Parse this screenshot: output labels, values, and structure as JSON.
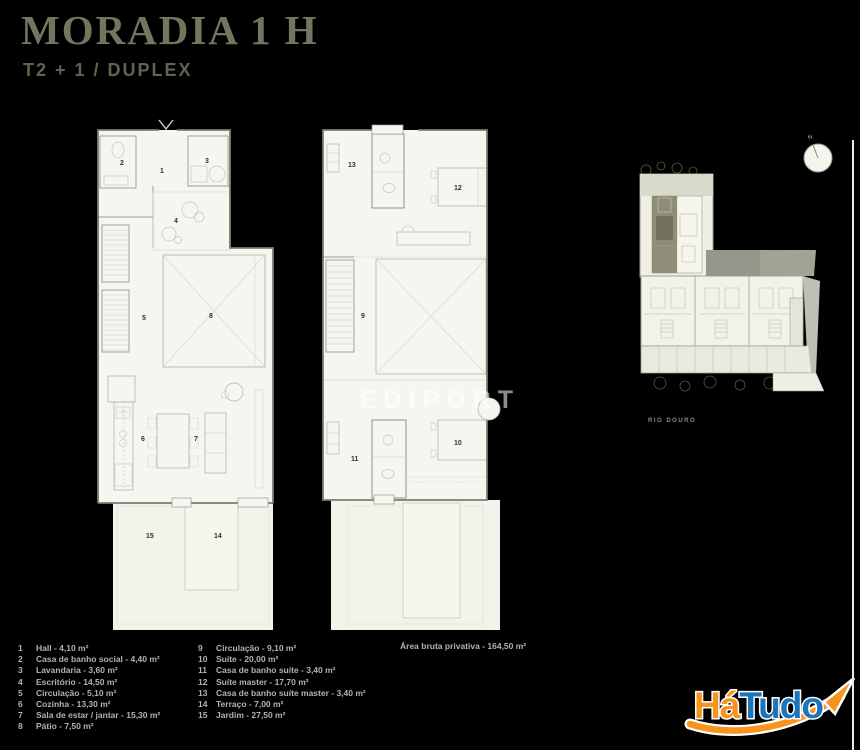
{
  "header": {
    "title": "MORADIA 1 H",
    "subtitle": "T2 + 1 / DUPLEX"
  },
  "room_numbers": {
    "hall": "1",
    "wc_social": "2",
    "lavandaria": "3",
    "escritorio": "4",
    "circulacao_0": "5",
    "cozinha": "6",
    "sala": "7",
    "patio": "8",
    "circulacao_1": "9",
    "suite": "10",
    "wc_suite": "11",
    "suite_master": "12",
    "wc_suite_master": "13",
    "terraco": "14",
    "jardim": "15"
  },
  "legend": {
    "col1": [
      {
        "num": "1",
        "label": "Hall - 4,10 m²"
      },
      {
        "num": "2",
        "label": "Casa de banho social - 4,40 m²"
      },
      {
        "num": "3",
        "label": "Lavandaria - 3,60 m²"
      },
      {
        "num": "4",
        "label": "Escritório - 14,50 m²"
      },
      {
        "num": "5",
        "label": "Circulação - 5,10 m²"
      },
      {
        "num": "6",
        "label": "Cozinha - 13,30 m²"
      },
      {
        "num": "7",
        "label": "Sala de estar / jantar - 15,30 m²"
      },
      {
        "num": "8",
        "label": "Pátio - 7,50 m²"
      }
    ],
    "col2": [
      {
        "num": "9",
        "label": "Circulação - 9,10 m²"
      },
      {
        "num": "10",
        "label": "Suíte - 20,00 m²"
      },
      {
        "num": "11",
        "label": "Casa de banho suíte - 3,40 m²"
      },
      {
        "num": "12",
        "label": "Suíte master - 17,70 m²"
      },
      {
        "num": "13",
        "label": "Casa de banho suíte master - 3,40 m²"
      },
      {
        "num": "14",
        "label": "Terraço - 7,00 m²"
      },
      {
        "num": "15",
        "label": "Jardim - 27,50 m²"
      }
    ],
    "total": "Área bruta privativa - 164,50 m²"
  },
  "site": {
    "caption": "RIO DOURO",
    "compass_label": "N"
  },
  "watermark": "EDIPORT",
  "logo": {
    "part1": "Há",
    "part2": "Tudo"
  },
  "colors": {
    "accent_orange": "#f7941d",
    "accent_blue": "#1b75bc",
    "title": "#75755f",
    "plan_bg": "#f6f6f0"
  }
}
